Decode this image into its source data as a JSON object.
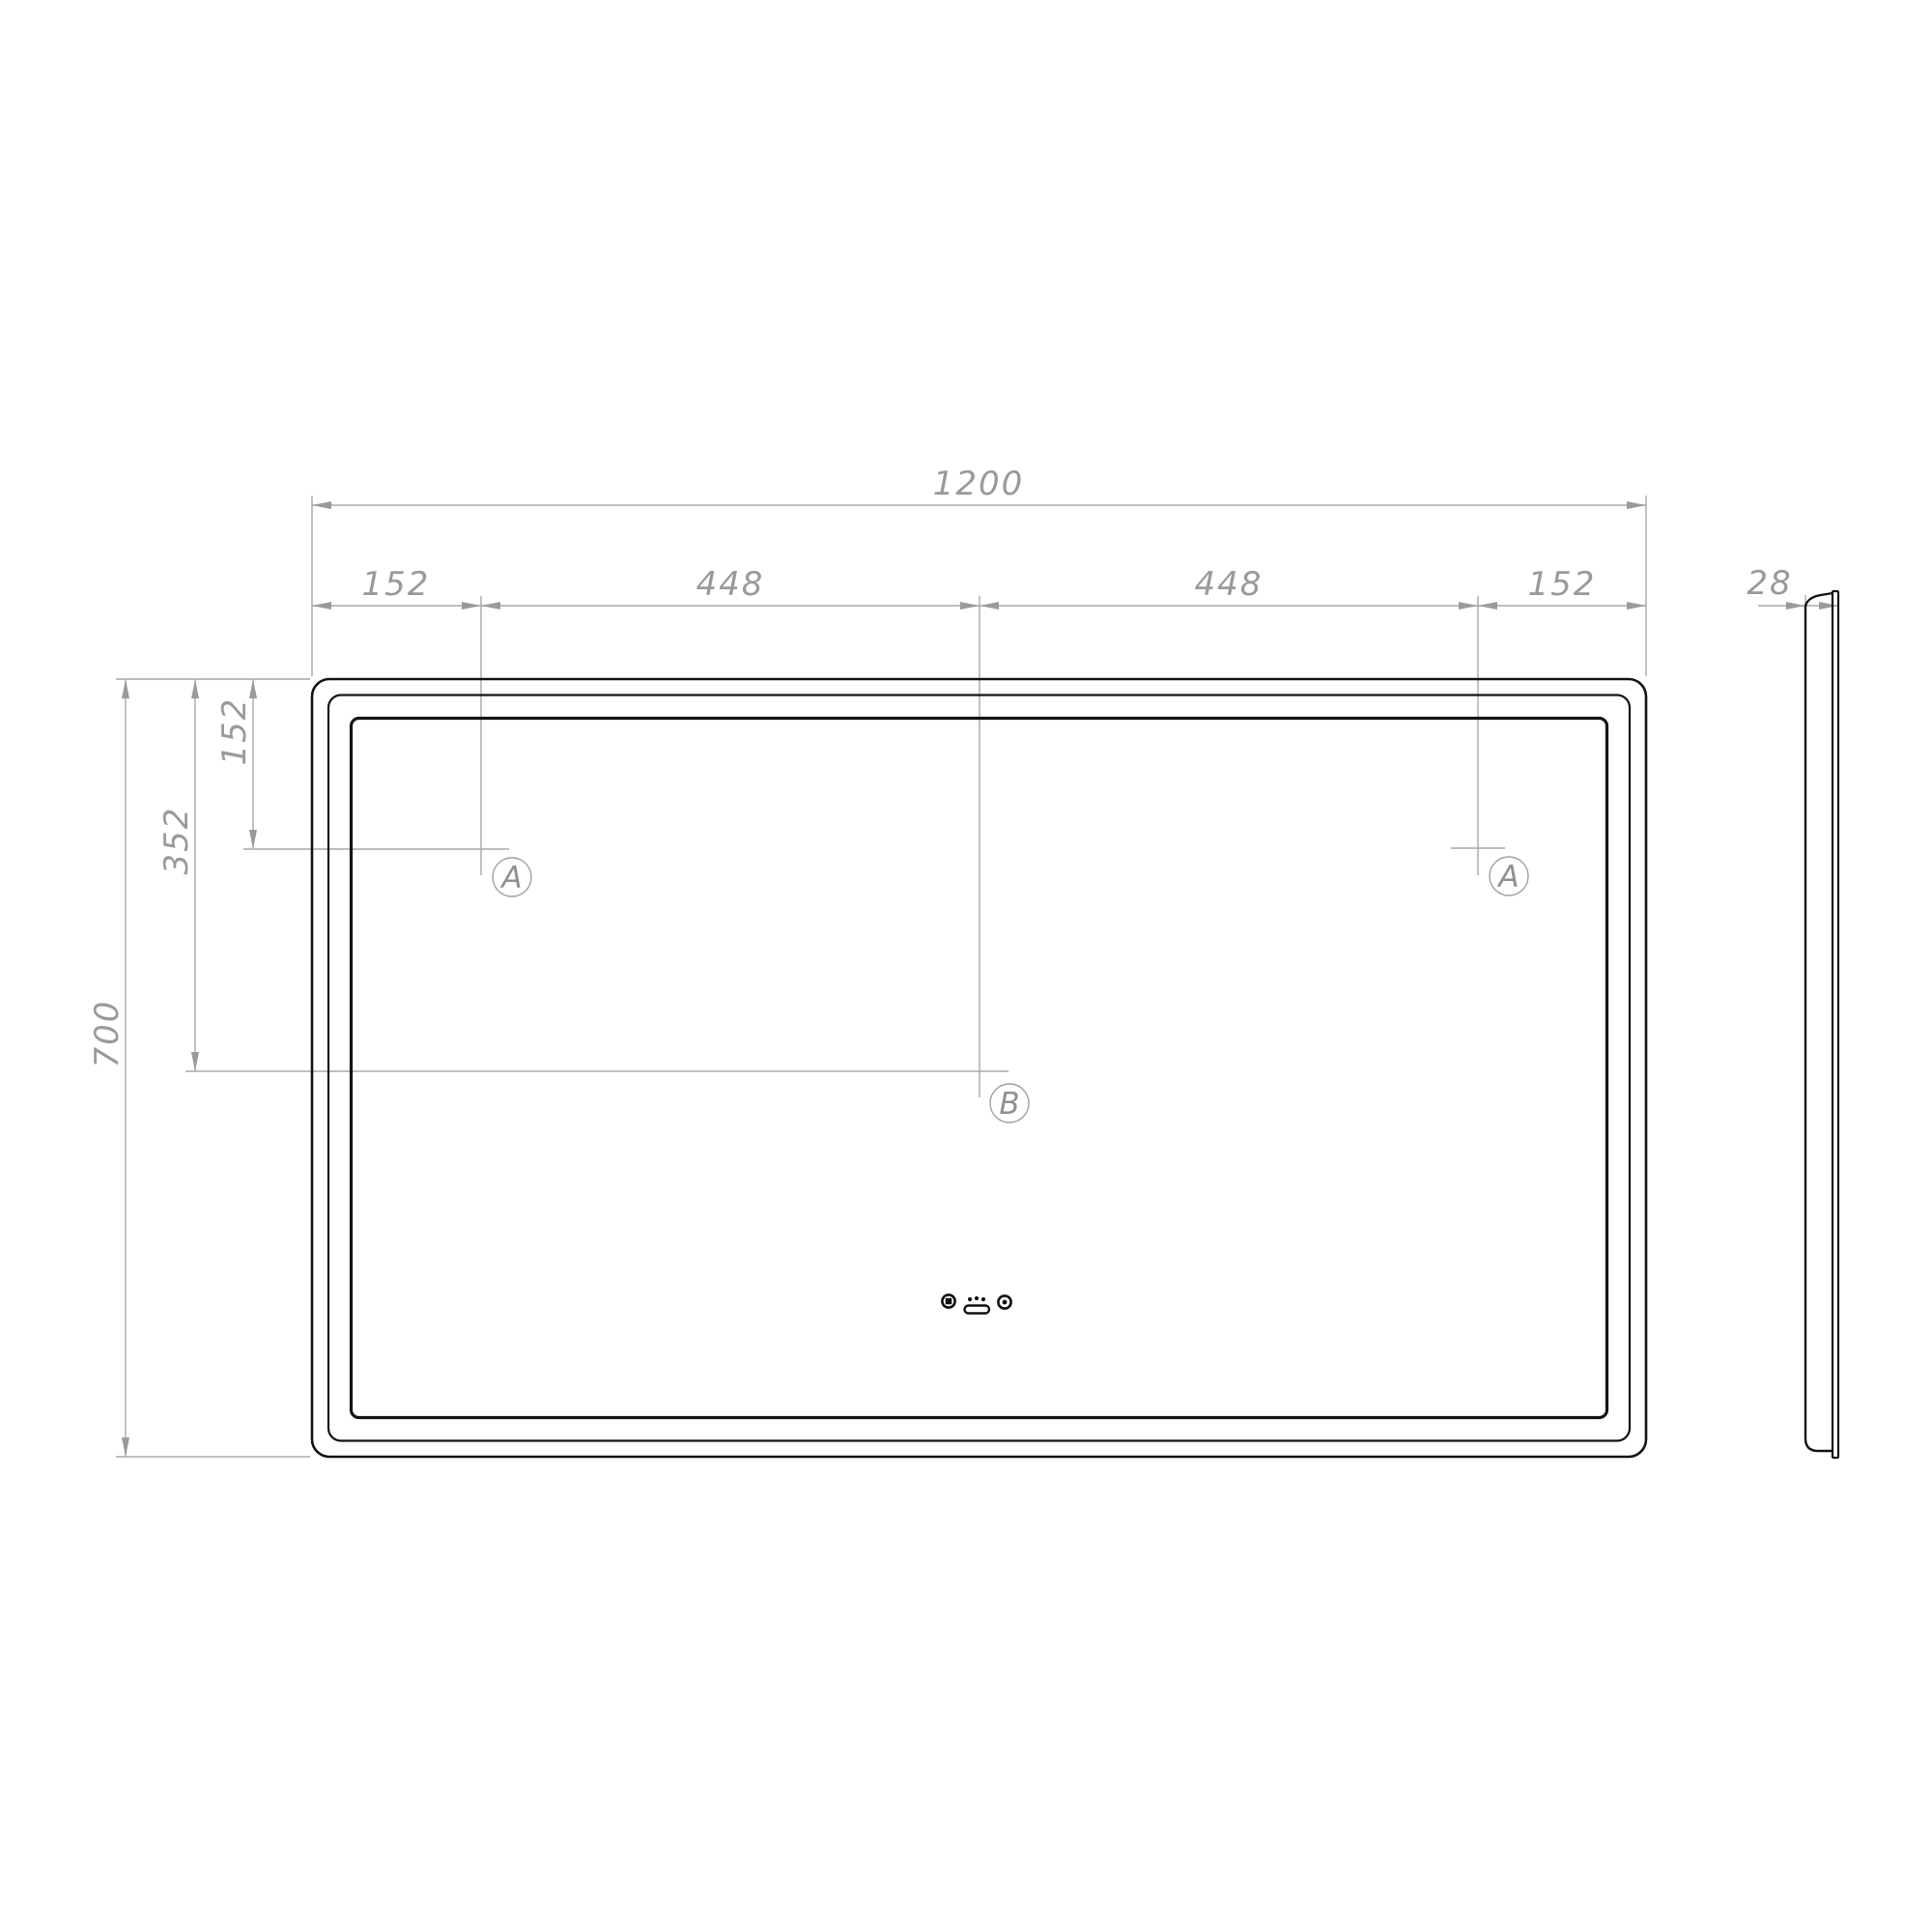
{
  "front_view": {
    "width_total": "1200",
    "width_segments": [
      "152",
      "448",
      "448",
      "152"
    ],
    "height_total": "700",
    "height_segment_152": "152",
    "height_segment_352": "352",
    "marker_hole_left": "A",
    "marker_hole_right": "A",
    "marker_center": "B"
  },
  "side_view": {
    "thickness": "28"
  },
  "icons": [
    {
      "name": "dimmer-touch-icon"
    },
    {
      "name": "anti-fog-icon"
    },
    {
      "name": "light-touch-icon"
    }
  ],
  "colors": {
    "outline": "#141414",
    "dimension_line": "#a8a8a8",
    "dimension_text": "#9a9a9a",
    "background": "#ffffff"
  }
}
